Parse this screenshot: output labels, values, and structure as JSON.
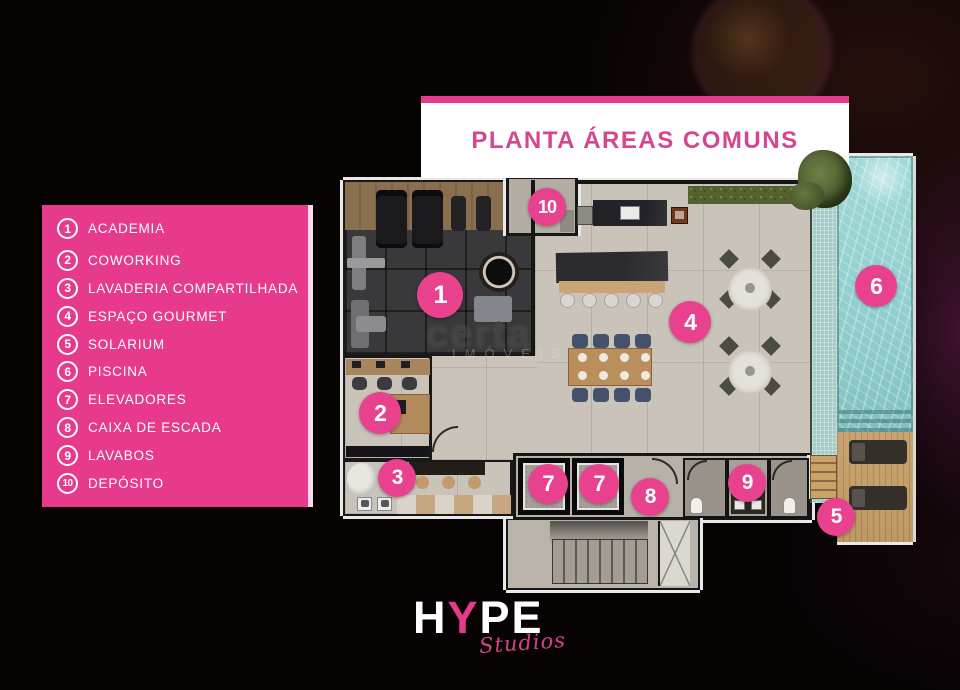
{
  "colors": {
    "brand_pink": "#e73a8c",
    "title_pink": "#d6468f",
    "marker_pink": "#e8428f",
    "pool_teal": "#8fcecc",
    "floor_beige": "#c9c3b9"
  },
  "title": {
    "text": "PLANTA ÁREAS COMUNS"
  },
  "legend": {
    "items": [
      {
        "num": "1",
        "label": "ACADEMIA"
      },
      {
        "num": "2",
        "label": "COWORKING"
      },
      {
        "num": "3",
        "label": "LAVADERIA COMPARTILHADA"
      },
      {
        "num": "4",
        "label": "ESPAÇO GOURMET"
      },
      {
        "num": "5",
        "label": "SOLARIUM"
      },
      {
        "num": "6",
        "label": "PISCINA"
      },
      {
        "num": "7",
        "label": "ELEVADORES"
      },
      {
        "num": "8",
        "label": "CAIXA DE ESCADA"
      },
      {
        "num": "9",
        "label": "LAVABOS"
      },
      {
        "num": "10",
        "label": "DEPÓSITO"
      }
    ]
  },
  "markers": [
    {
      "num": "1",
      "x": 440,
      "y": 295,
      "r": 23
    },
    {
      "num": "2",
      "x": 380,
      "y": 413,
      "r": 21
    },
    {
      "num": "3",
      "x": 397,
      "y": 478,
      "r": 19
    },
    {
      "num": "4",
      "x": 690,
      "y": 322,
      "r": 21
    },
    {
      "num": "5",
      "x": 836,
      "y": 517,
      "r": 19
    },
    {
      "num": "6",
      "x": 876,
      "y": 286,
      "r": 21
    },
    {
      "num": "7",
      "x": 548,
      "y": 484,
      "r": 20
    },
    {
      "num": "7",
      "x": 599,
      "y": 484,
      "r": 20
    },
    {
      "num": "8",
      "x": 650,
      "y": 497,
      "r": 19
    },
    {
      "num": "9",
      "x": 747,
      "y": 483,
      "r": 19
    },
    {
      "num": "10",
      "x": 547,
      "y": 207,
      "r": 19
    }
  ],
  "watermark": {
    "line1": "certa",
    "line2": "IMÓVEIS"
  },
  "logo": {
    "part1": "H",
    "part2": "Y",
    "part3": "PE",
    "script": "Studios"
  }
}
